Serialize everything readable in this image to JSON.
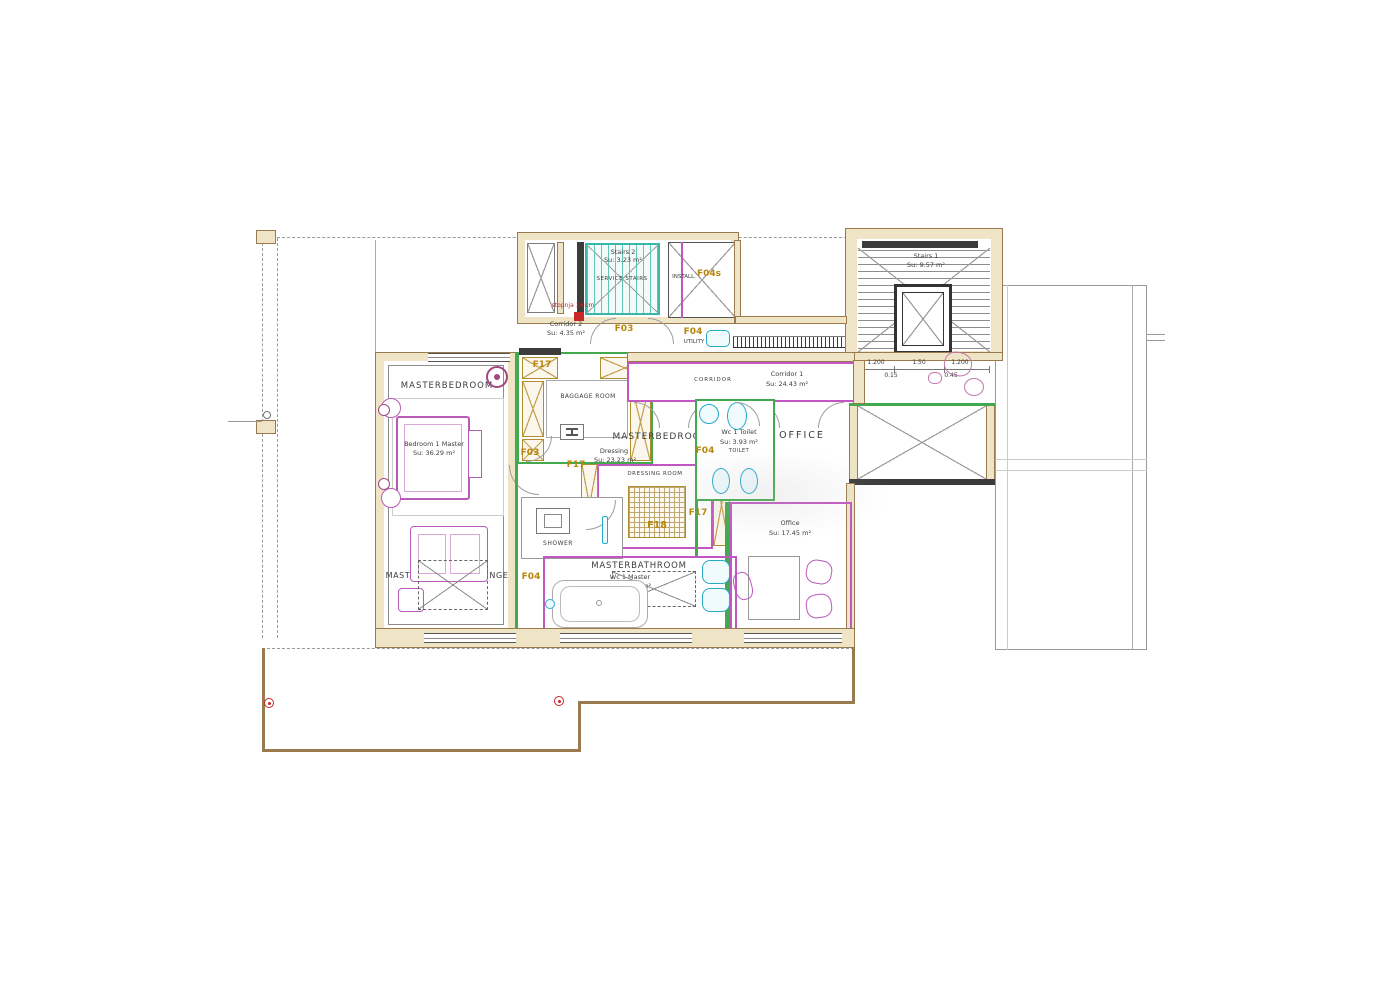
{
  "drawing": {
    "type": "architectural floor plan",
    "floor": "master suite level"
  },
  "colors": {
    "wall_fill": "#efe5c6",
    "wall_edge": "#9a7b4f",
    "green_wall": "#43a94e",
    "magenta_room": "#c257c2",
    "teal_stairs": "#3bb7a8",
    "gold_label": "#b8860b",
    "cyan_fixture": "#25aac8",
    "red_marker": "#c62828",
    "ink": "#3b3b3b",
    "terrace_outline": "#9a7b4f"
  },
  "rooms": {
    "master_bedroom": {
      "name": "MASTERBEDROOM",
      "detail1": "Bedroom 1 Master",
      "detail2": "Su: 36.29 m²"
    },
    "lounge": {
      "name": "MASTERBEDROOM LOUNGE"
    },
    "stairs2": {
      "name": "Stairs 2",
      "area": "Su: 3.23 m²",
      "sub": "SERVICE STAIRS"
    },
    "install": {
      "name": "INSTALL."
    },
    "corridor2": {
      "name": "Corridor 2",
      "area": "Su: 4.35 m²"
    },
    "utility": {
      "name": "UTILITY"
    },
    "baggage": {
      "name": "BAGGAGE ROOM"
    },
    "corridor1": {
      "sub": "CORRIDOR",
      "name": "Corridor 1",
      "area": "Su: 24.43 m²"
    },
    "suite": {
      "name": "MASTERBEDROOM",
      "detail1": "Dressing",
      "detail2": "Su: 23.23 m²"
    },
    "dressing": {
      "name": "DRESSING ROOM"
    },
    "toilet": {
      "name": "Wc 1 Toilet",
      "area": "Su: 3.93 m²",
      "sub": "TOILET"
    },
    "office_hall": {
      "name": "OFFICE"
    },
    "office": {
      "name": "Office",
      "area": "Su: 17.45 m²"
    },
    "shower": {
      "name": "SHOWER"
    },
    "bathroom": {
      "name": "MASTERBATHROOM",
      "detail1": "Wc 1 Master",
      "detail2": "Su: 17.55 m²",
      "sub": "TUB"
    },
    "stairs1": {
      "name": "Stairs 1",
      "area": "Su: 9.57 m²"
    }
  },
  "door_labels": {
    "f03": "F03",
    "f04": "F04",
    "f17": "F17",
    "f18": "F18",
    "f04s": "F04s"
  },
  "annotations": {
    "step_note": "stopnja 16 cm"
  },
  "dimensions": {
    "left": "1.200",
    "mid": "1.50",
    "right": "1.200",
    "off1": "0.15",
    "off2": "0.45"
  }
}
